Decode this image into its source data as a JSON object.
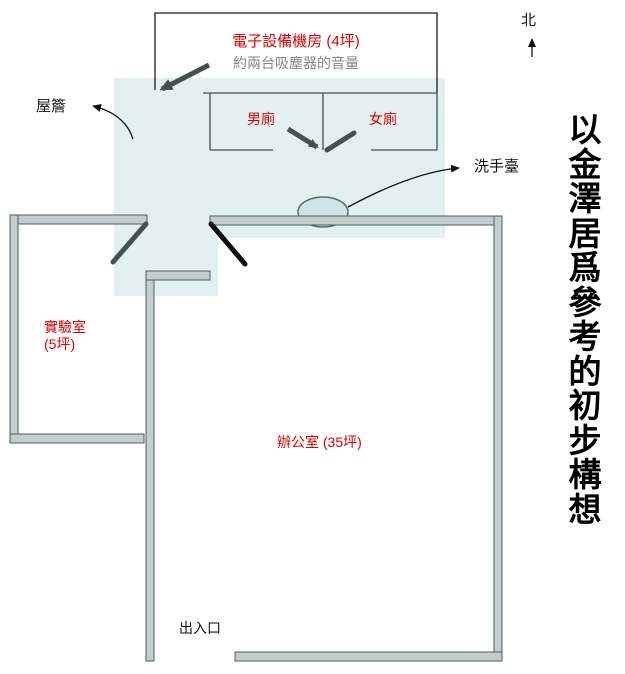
{
  "colors": {
    "accent_red": "#d90000",
    "note_gray": "#858585",
    "zone_blue": "#e3f0f1",
    "basin_blue": "#cfe4e6",
    "wall_fill": "#c4cdcd",
    "wall_stroke": "#4e5e5e",
    "line_dark": "#3d4d4d",
    "door_slate": "#44514e",
    "ink_black": "#111111"
  },
  "labels": {
    "equipment_room": "電子設備機房 (4坪)",
    "equipment_room_note": "約兩台吸塵器的音量",
    "north": "北",
    "eaves": "屋簷",
    "mens_toilet": "男廁",
    "womens_toilet": "女廁",
    "washbasin": "洗手臺",
    "lab_name": "實驗室",
    "lab_area": "(5坪)",
    "office": "辦公室 (35坪)",
    "entrance": "出入口",
    "side_title": "以金澤居爲參考的初步構想"
  }
}
